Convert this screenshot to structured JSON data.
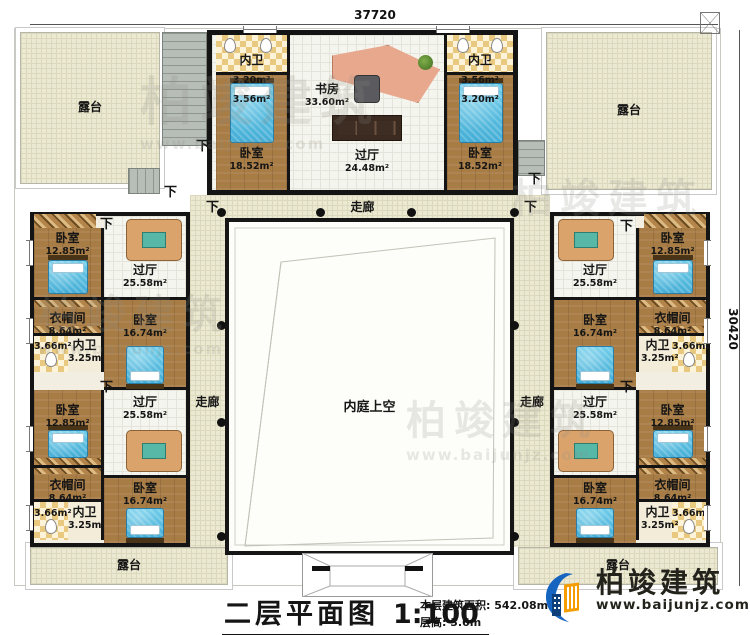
{
  "dimensions": {
    "top": "37720",
    "right": "30420"
  },
  "labels": {
    "down": "下",
    "corridor": "走廊",
    "courtyard_void": "内庭上空",
    "terrace": "露台"
  },
  "top_block": {
    "study": {
      "name": "书房",
      "area": "33.60m²"
    },
    "hall": {
      "name": "过厅",
      "area": "24.48m²"
    },
    "bedroom_left": {
      "name": "卧室",
      "area": "18.52m²"
    },
    "bedroom_right": {
      "name": "卧室",
      "area": "18.52m²"
    },
    "bath_left": {
      "name": "内卫",
      "area_a": "3.20m²",
      "area_b": "3.56m²"
    },
    "bath_right": {
      "name": "内卫",
      "area_a": "3.56m²",
      "area_b": "3.20m²"
    }
  },
  "wing_rooms": {
    "hall": {
      "name": "过厅",
      "area": "25.58m²"
    },
    "bedroom_outer": {
      "name": "卧室",
      "area": "12.85m²"
    },
    "bedroom_inner": {
      "name": "卧室",
      "area": "16.74m²"
    },
    "closet": {
      "name": "衣帽间",
      "area": "8.64m²"
    },
    "bath": {
      "name": "内卫",
      "area": "3.25m²",
      "aux_area": "3.66m²"
    }
  },
  "title_block": {
    "title": "二层平面图",
    "scale": "1:100",
    "floor_area": "本层建筑面积: 542.08m²",
    "floor_height": "层高: 3.6m"
  },
  "branding": {
    "brand": "柏竣建筑",
    "website": "www.baijunjz.com"
  },
  "colors": {
    "wall": "#141414",
    "wood_floor": "#a87c45",
    "terrace": "#ece9d3",
    "bed": "#5ec4e6",
    "tile_accent": "#e8c97f",
    "logo_blue": "#1565c0",
    "logo_orange": "#f59d00"
  }
}
